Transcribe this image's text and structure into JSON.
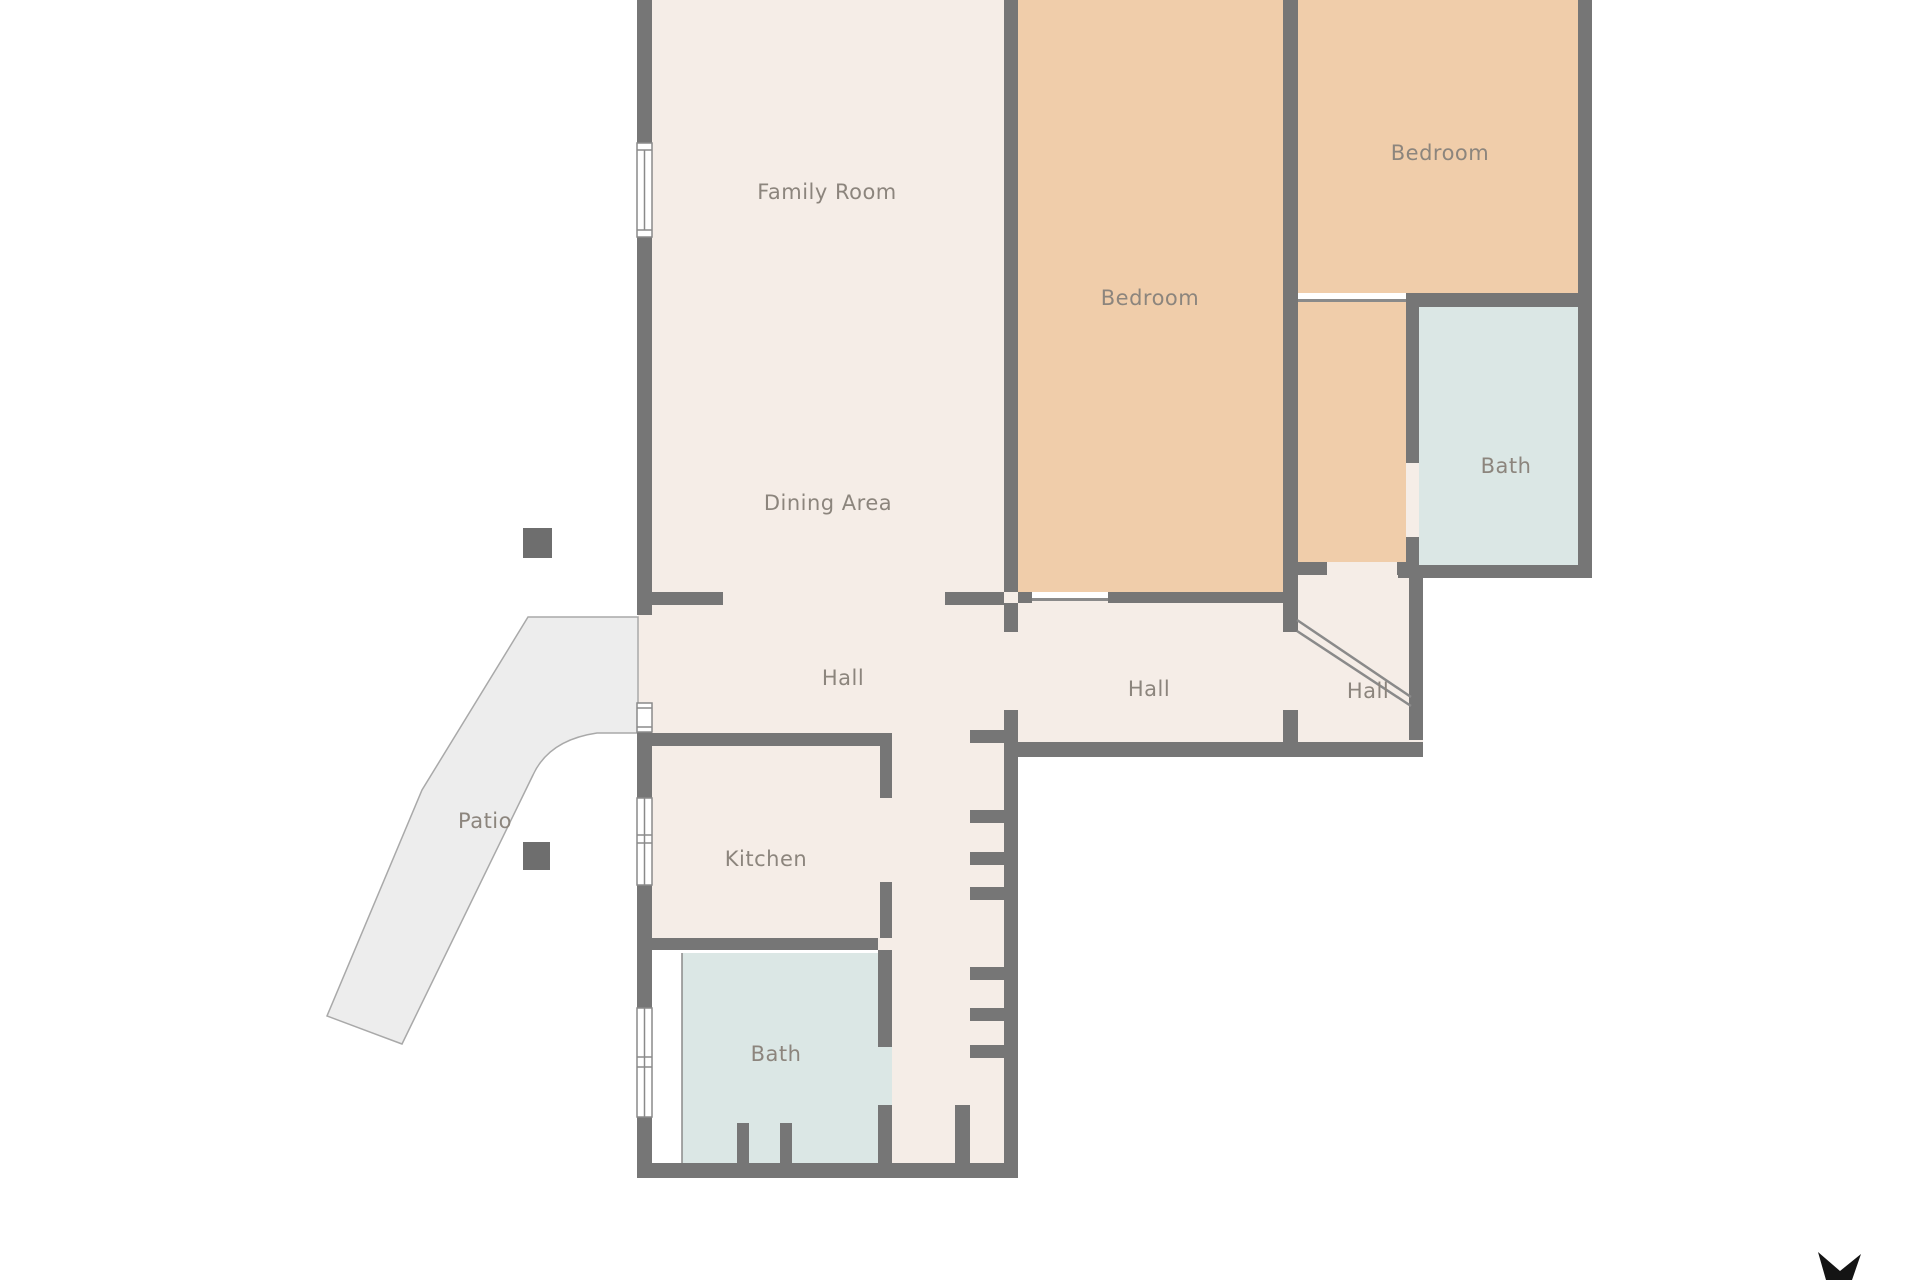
{
  "title": "Floor Plan",
  "colors": {
    "wall": "#767676",
    "floor": "#f5ede7",
    "bedroom": "#f0cdaa",
    "bath": "#dbe7e5",
    "patio": "#ededed",
    "patio_border": "#a9a9a9",
    "label": "#8c857d",
    "window_border": "#8a8a8a",
    "threshold": "#8a8a8a",
    "post": "#6e6e6e",
    "compass": "#141414",
    "white": "#ffffff"
  },
  "rooms": {
    "family_room": {
      "label": "Family Room"
    },
    "dining_area": {
      "label": "Dining Area"
    },
    "bedroom_center": {
      "label": "Bedroom"
    },
    "bedroom_top_right": {
      "label": "Bedroom"
    },
    "bath_top_right": {
      "label": "Bath"
    },
    "hall_left": {
      "label": "Hall"
    },
    "hall_center": {
      "label": "Hall"
    },
    "hall_far_right": {
      "label": "Hall"
    },
    "kitchen": {
      "label": "Kitchen"
    },
    "bath_bottom": {
      "label": "Bath"
    },
    "patio": {
      "label": "Patio"
    }
  },
  "icons": {
    "compass": "north-arrow"
  }
}
